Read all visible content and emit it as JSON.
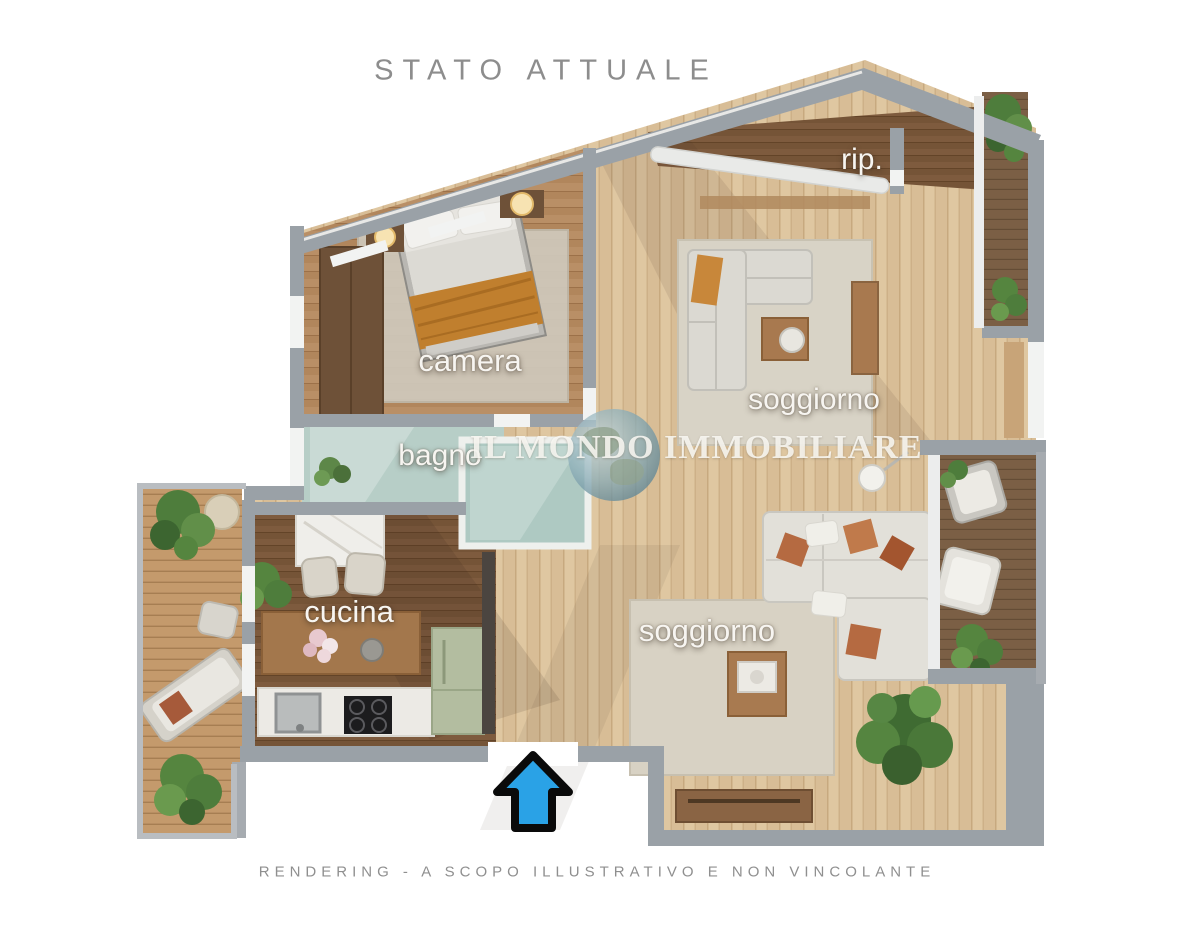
{
  "title": "STATO ATTUALE",
  "disclaimer": "RENDERING - A SCOPO ILLUSTRATIVO E NON VINCOLANTE",
  "watermark": {
    "text": "IL MONDO IMMOBILIARE",
    "icon": "globe-icon"
  },
  "rooms": {
    "rip": {
      "label": "rip."
    },
    "camera": {
      "label": "camera"
    },
    "bagno": {
      "label": "bagno"
    },
    "soggiorno_upper": {
      "label": "soggiorno"
    },
    "cucina": {
      "label": "cucina"
    },
    "soggiorno_lower": {
      "label": "soggiorno"
    }
  },
  "entrance": {
    "icon": "entrance-arrow-icon",
    "arrow_color": "#2aa2e6"
  },
  "palette": {
    "wall_gray": "#9aa1a7",
    "floor_light_wood": "#dfc7a1",
    "floor_mid_wood": "#b98f66",
    "floor_dark_wood": "#7e5b3e",
    "deck_wood": "#c49a6c",
    "bagno_marble": "#b7cec7",
    "label_text": "#f7f5f1",
    "title_text": "#8d8d8d",
    "arrow_blue": "#2aa2e6"
  }
}
